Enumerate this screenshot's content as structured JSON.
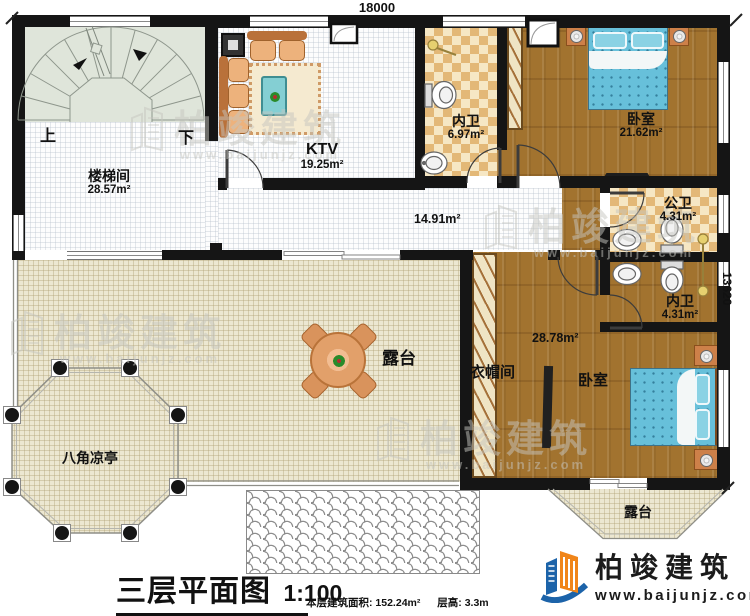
{
  "dimensions": {
    "top": "18000",
    "right": "13620"
  },
  "rooms": {
    "stair": {
      "name": "楼梯间",
      "area": "28.57m²"
    },
    "up": "上",
    "down": "下",
    "ktv": {
      "name": "KTV",
      "area": "19.25m²"
    },
    "bath_top": {
      "name": "内卫",
      "area": "6.97m²"
    },
    "bedroom1": {
      "name": "卧室",
      "area": "21.62m²"
    },
    "corridor": {
      "area": "14.91m²"
    },
    "public_bath": {
      "name": "公卫",
      "area": "4.31m²"
    },
    "bath_lower": {
      "name": "内卫",
      "area": "4.31m²"
    },
    "bedroom2": {
      "name": "卧室",
      "area": "28.78m²"
    },
    "cloakroom": {
      "name": "衣帽间"
    },
    "terrace_main": {
      "name": "露台"
    },
    "terrace_small": {
      "name": "露台"
    },
    "pavilion": {
      "name": "八角凉亭"
    }
  },
  "title": {
    "text": "三层平面图",
    "scale": "1:100",
    "floor_area_label": "本层建筑面积: 152.24m²",
    "floor_height_label": "层高: 3.3m"
  },
  "brand": {
    "name": "柏竣建筑",
    "website": "www.baijunjz.com"
  },
  "watermark": {
    "name": "柏竣建筑",
    "website": "www.baijunjz.com"
  },
  "colors": {
    "wall": "#151515",
    "wood": "#a2732f",
    "tile_dark": "#e3b877",
    "tile_light": "#f6e7c4",
    "terrace": "#ece7d1",
    "bed": "#67c0da",
    "brand_orange": "#f08519",
    "brand_blue": "#1c63a9"
  }
}
